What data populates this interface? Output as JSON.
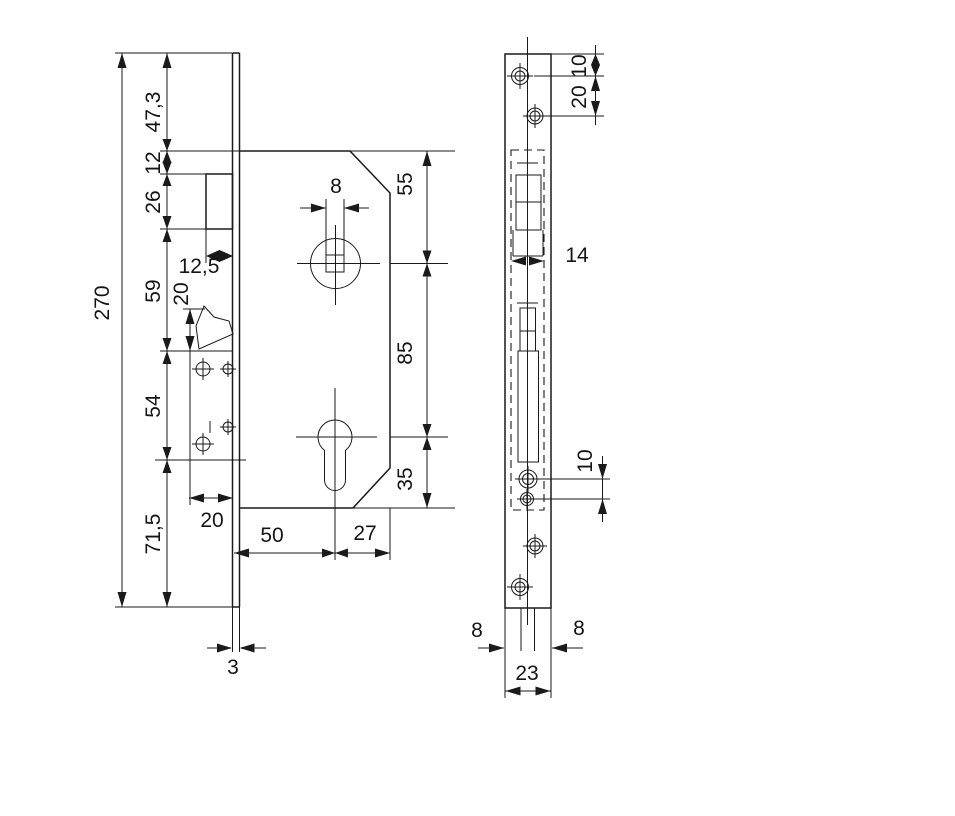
{
  "dims": {
    "overall_height": "270",
    "seg_top": "47,3",
    "seg_latch_offset": "12",
    "seg_latch": "26",
    "seg_mid": "59",
    "seg_lower": "54",
    "seg_bottom": "71,5",
    "latch_protrusion": "12,5",
    "latch_bevel_height": "20",
    "aux_offset": "20",
    "spindle_square": "8",
    "top_to_spindle": "55",
    "spindle_to_cylinder": "85",
    "cylinder_to_bottom": "35",
    "backset": "50",
    "case_depth_ext": "27",
    "faceplate_thickness": "3",
    "plate_top_to_hole": "10",
    "screw_hole_spacing": "20",
    "mortise_width": "14",
    "cylinder_hole_spacing": "10",
    "edge_offset_left": "8",
    "edge_offset_right": "8",
    "faceplate_width": "23"
  }
}
